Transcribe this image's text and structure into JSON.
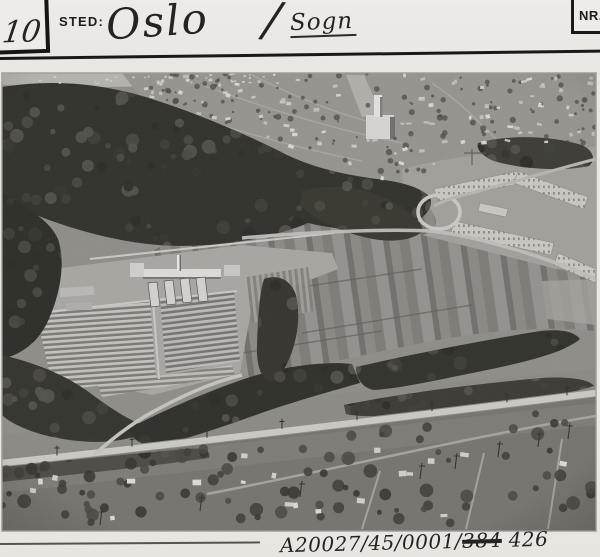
{
  "card": {
    "top_left_number": "10",
    "sted_label": "STED:",
    "place_primary": "Oslo",
    "place_separator": "/",
    "place_secondary": "Sogn",
    "nr_label": "NR.",
    "photo_code": {
      "prefix": "A20027/45/0001/",
      "struck": "384",
      "suffix": " 426"
    },
    "photo_alt": "Oblique aerial photograph of Sogn in Oslo: nursery with greenhouses and striped cold-frame beds, market-garden fields, housing blocks under construction at upper right, villa suburb and church behind, dark forest at left, and a main road with villas along the bottom edge."
  },
  "colors": {
    "card_background": "#e9e7e2",
    "ink": "#1c1c1a",
    "photo_dark_forest": "#30302a",
    "photo_light_structures": "#d6d4d0"
  }
}
